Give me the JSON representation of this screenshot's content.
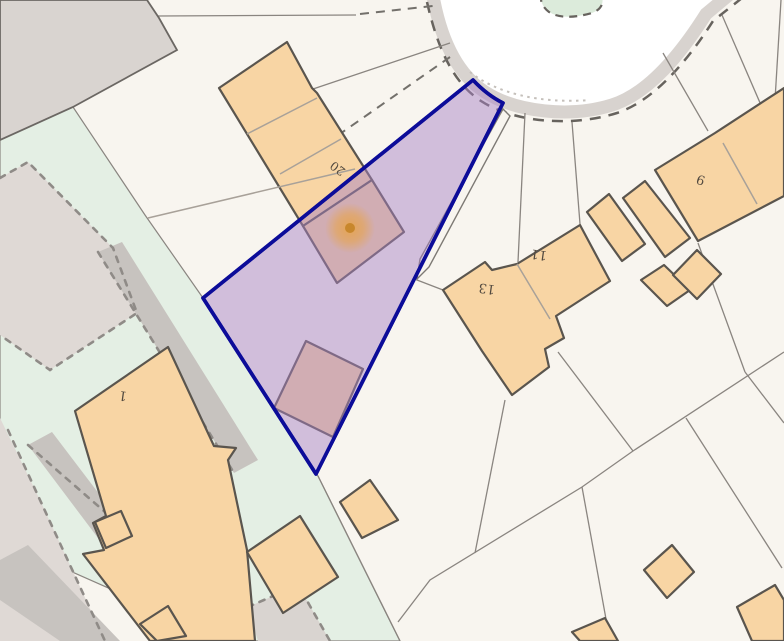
{
  "map": {
    "description": "Cadastral title-plan map with highlighted parcel",
    "labels": {
      "plot20": "20",
      "plot13": "13",
      "plot11": "11",
      "plot9": "9",
      "plot1": "1"
    },
    "colors": {
      "background": "#f8f5ef",
      "road_surface": "#ffffff",
      "road_band": "#d8d3cf",
      "road_dash": "#67635e",
      "green_space": "#e4efe4",
      "green_island": "#dcebdb",
      "grey_building_fill": "#d9d4d0",
      "grey_building_stroke": "#6b6763",
      "beige_parcel_fill": "#dfd9d5",
      "beige_parcel_dash": "#8f8b87",
      "grey_path_fill": "#c7c3bf",
      "building_fill": "#f8d5a4",
      "building_stroke": "#5a554e",
      "inner_wall": "#a8a199",
      "boundary_line": "#8a8580",
      "highlight_fill": "rgba(168,130,196,0.48)",
      "highlight_border": "#0c0c99",
      "marker_halo": "#e8a345",
      "marker_dot": "#c8872c"
    }
  }
}
